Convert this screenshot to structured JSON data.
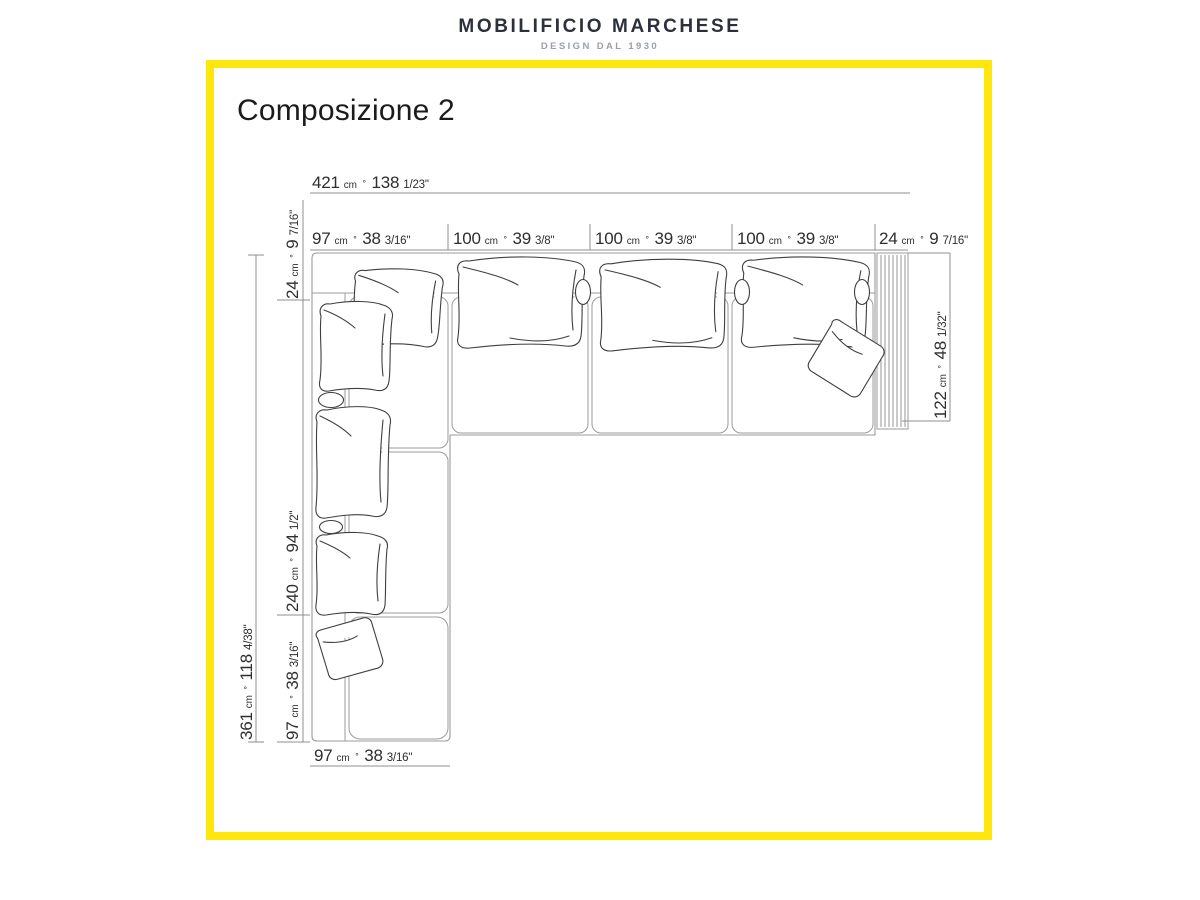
{
  "brand": {
    "name": "MOBILIFICIO MARCHESE",
    "tagline": "DESIGN DAL 1930"
  },
  "title": "Composizione 2",
  "units": {
    "cm": "cm",
    "sep": "∘"
  },
  "dims": {
    "total_width": {
      "cm": "421",
      "in": "138",
      "frac": "1/23\""
    },
    "segments_top": [
      {
        "cm": "97",
        "in": "38",
        "frac": "3/16\""
      },
      {
        "cm": "100",
        "in": "39",
        "frac": "3/8\""
      },
      {
        "cm": "100",
        "in": "39",
        "frac": "3/8\""
      },
      {
        "cm": "100",
        "in": "39",
        "frac": "3/8\""
      },
      {
        "cm": "24",
        "in": "9",
        "frac": "7/16\""
      }
    ],
    "left_segments": [
      {
        "cm": "24",
        "in": "9",
        "frac": "7/16\""
      },
      {
        "cm": "240",
        "in": "94",
        "frac": "1/2\""
      },
      {
        "cm": "97",
        "in": "38",
        "frac": "3/16\""
      }
    ],
    "total_height": {
      "cm": "361",
      "in": "118",
      "frac": "4/38\""
    },
    "right_depth": {
      "cm": "122",
      "in": "48",
      "frac": "1/32\""
    },
    "bottom_width": {
      "cm": "97",
      "in": "38",
      "frac": "3/16\""
    }
  },
  "colors": {
    "frame_yellow": "#FFE70D",
    "dimension_line": "#8f8f8f",
    "sofa_outline": "#9b9b9b",
    "sketch_line": "#3f3f3f",
    "dimension_text": "#2e2e2e",
    "brand_text": "#2b313b",
    "tagline_text": "#9aa0a8"
  }
}
